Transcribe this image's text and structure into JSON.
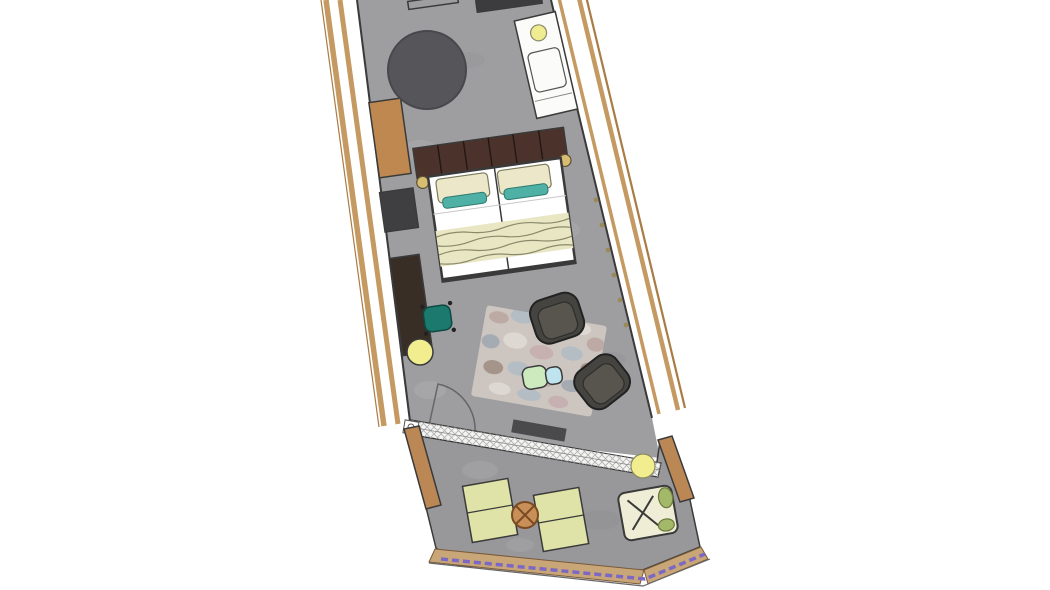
{
  "scene": {
    "label": "Floor plan of a hotel room with balcony terrace, rotated layout",
    "type": "floor-plan",
    "areas": [
      {
        "name": "main room",
        "furniture": [
          "wall unit",
          "wooden wardrobe bench",
          "minibar cabinet",
          "round dark rug",
          "white vanity cabinet with round lamp",
          "double bed with padded headboard",
          "two pillows with teal accents",
          "foot throw blanket",
          "two reading lights",
          "wall desk",
          "teal desk chair",
          "yellow pouf",
          "mottled lounge rug",
          "two charcoal armchairs",
          "two-tone side table",
          "glass door with swing arc",
          "dark doormat",
          "hatched sliding-door threshold",
          "curtain glider dots"
        ]
      },
      {
        "name": "terrace",
        "furniture": [
          "two pale green loungers",
          "round wooden side table",
          "yellow pouf",
          "folding table with X frame and plant",
          "wooden privacy partitions",
          "wooden deck edge band",
          "purple glass railing"
        ]
      }
    ]
  },
  "colors": {
    "background": "#ffffff",
    "outline": "#3a3a3a",
    "facade_wood": "#c59a62",
    "facade_wood_dark": "#a87c44",
    "floor_main": "#9e9ea1",
    "floor_terrace": "#98979a",
    "threshold": "#f4f4f2",
    "wall_unit": "#3c3c3e",
    "wardrobe_wood": "#bf8850",
    "minibar": "#3f3e40",
    "round_rug": "#56565a",
    "vanity": "#fbfbf9",
    "vanity_lamp": "#efec92",
    "headboard": "#4b332c",
    "mattress": "#ffffff",
    "pillow": "#ece7c9",
    "pillow_accent": "#4fb0a5",
    "throw": "#e9e6c4",
    "reading_light": "#d7bd72",
    "desk": "#382e26",
    "desk_chair": "#1b7a6d",
    "pouf": "#f2ee90",
    "rug_base": "#cdc6c0",
    "rug_rose": "#b59a94",
    "rug_blue": "#a3b8c6",
    "rug_brown": "#8d7668",
    "rug_cream": "#e8e4de",
    "rug_slate": "#8d9cab",
    "rug_pink": "#c2a3a8",
    "armchair": "#454440",
    "armchair_seat": "#57554e",
    "side_table_green": "#cdeabf",
    "side_table_blue": "#bfe4ef",
    "doormat": "#4a4a4c",
    "partition_wood": "#bb8855",
    "lounger": "#dfe3a8",
    "round_table": "#c89058",
    "round_table_stroke": "#7a4a22",
    "folding_table": "#f0edd6",
    "plant": "#a4b86a",
    "deck_band": "#c9a678",
    "railing": "#7b68c4",
    "glider_dot": "#9a8a58"
  }
}
